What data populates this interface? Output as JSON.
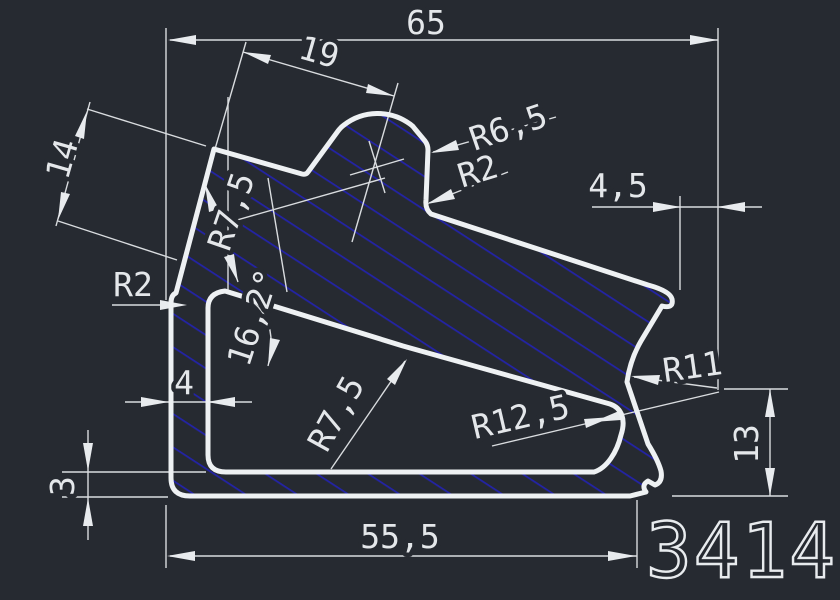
{
  "drawing": {
    "part_number": "3414",
    "colors": {
      "background": "#262a31",
      "outline": "#eef1f3",
      "hatch": "#2323a6",
      "text": "#e4e7ea"
    },
    "dimensions": {
      "total_width": "65",
      "bump_offset": "19",
      "left_side": "14",
      "tip_to_edge": "4,5",
      "left_wall": "4",
      "bottom_wall": "3",
      "bottom_width": "55,5",
      "right_height": "13",
      "angle": "16,2°"
    },
    "radii": {
      "bump_top": "R6,5",
      "bump_corner": "R2",
      "left_corner": "R2",
      "inner_top_left": "R7,5",
      "inner_mid": "R7,5",
      "inner_right": "R12,5",
      "notch": "R11"
    }
  }
}
